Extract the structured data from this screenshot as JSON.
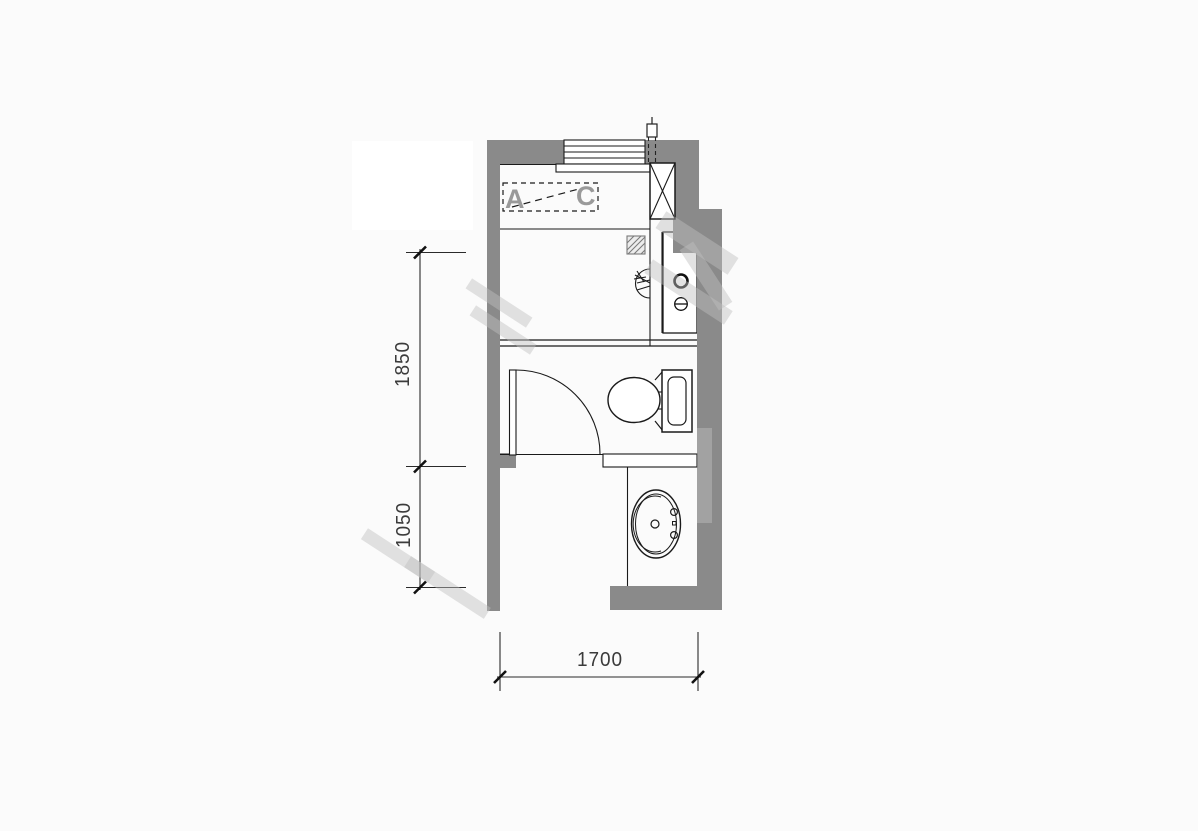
{
  "plan_title": "bathroom-floor-plan",
  "zone_labels": {
    "a": "A",
    "c": "C"
  },
  "dimensions": {
    "vertical_upper": "1850",
    "vertical_lower": "1050",
    "horizontal_bottom": "1700"
  },
  "colors": {
    "wall_fill": "#8a8a8a",
    "line": "#1a1a1a",
    "dim_text": "#3b3b3b",
    "zone_letter": "#9a9a9a",
    "watermark": "rgba(190,190,190,0.45)",
    "background": "#fbfbfb"
  },
  "fixtures": [
    "window",
    "pipe-riser",
    "shaft-column",
    "duct-hatch",
    "shower-head",
    "water-supply-points",
    "toilet",
    "door",
    "washbasin",
    "vanity-counter"
  ]
}
